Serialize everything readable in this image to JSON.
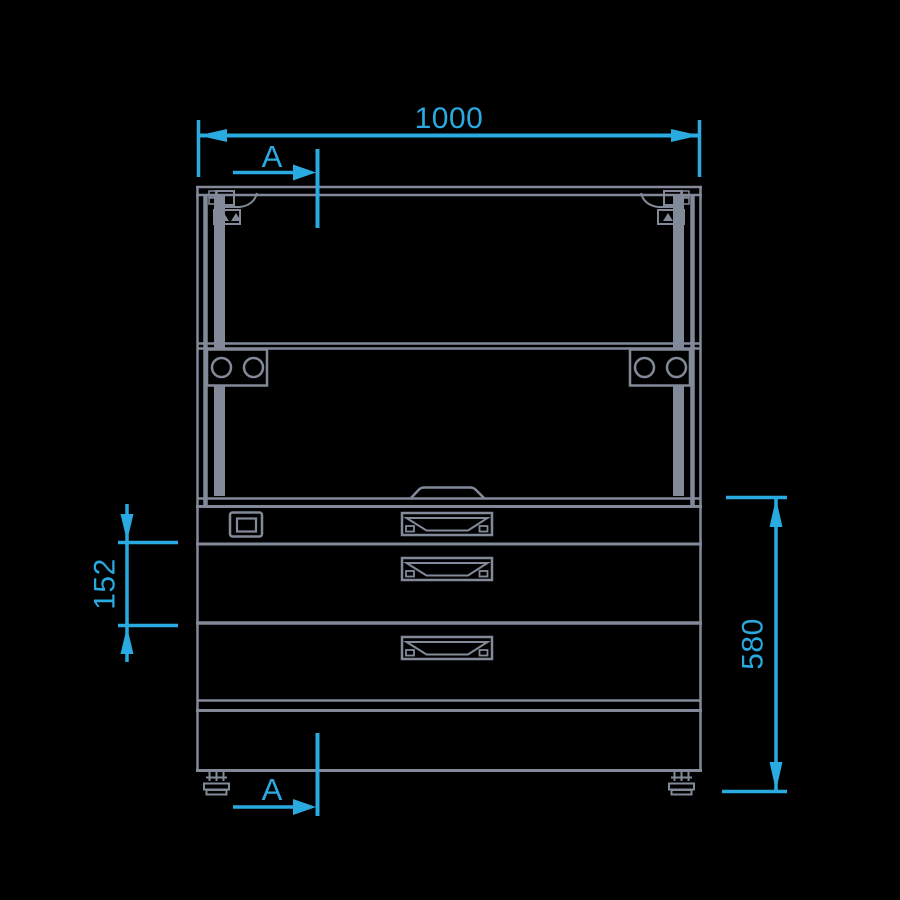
{
  "diagram": {
    "type": "technical-front-elevation",
    "background_color": "#000000",
    "line_color": "#828A99",
    "dimension_color": "#29ABE2",
    "dimensions": {
      "overall_width": "1000",
      "lower_section_height": "580",
      "drawer_pitch": "152"
    },
    "section_marker": "A",
    "features": {
      "drawer_count": 3,
      "handle_count": 3,
      "lock_count": 1,
      "hinge_plate_circles_per_side": 2,
      "feet_count": 2
    }
  }
}
